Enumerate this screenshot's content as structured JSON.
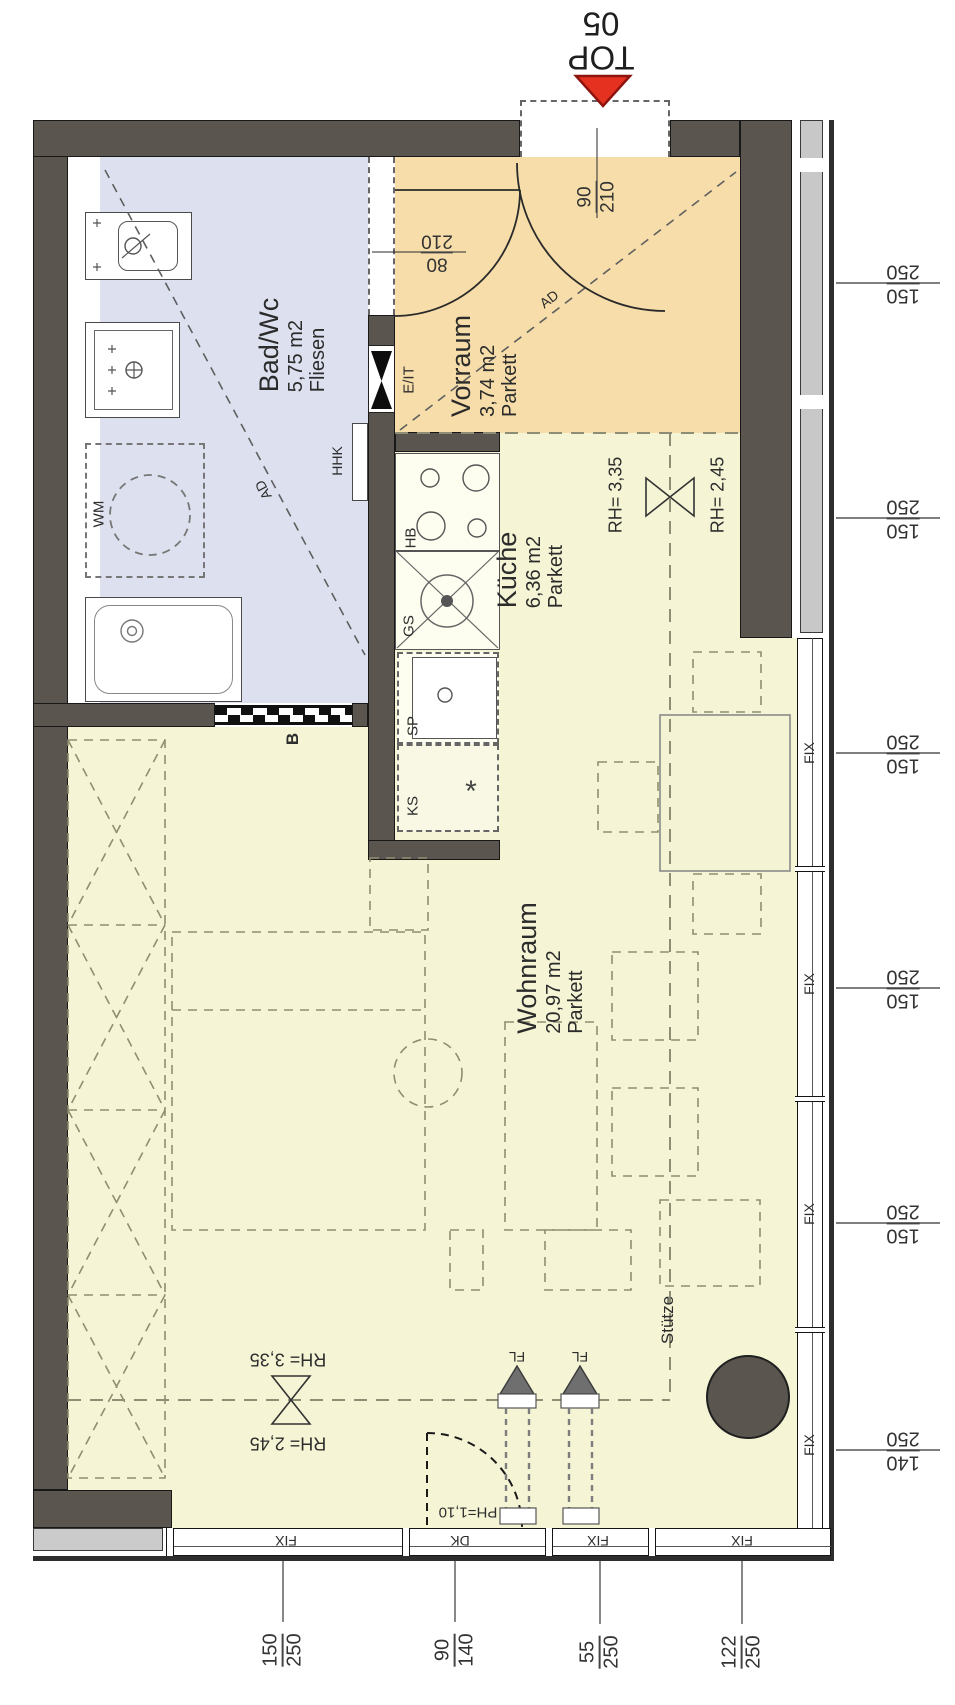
{
  "marker": {
    "line1": "TOP",
    "line2": "05"
  },
  "rooms": {
    "bad": {
      "name": "Bad/Wc",
      "area": "5,75  m2",
      "floor": "Fliesen"
    },
    "vorraum": {
      "name": "Vorraum",
      "area": "3,74  m2",
      "floor": "Parkett"
    },
    "kueche": {
      "name": "Küche",
      "area": "6,36  m2",
      "floor": "Parkett"
    },
    "wohnraum": {
      "name": "Wohnraum",
      "area": "20,97 m2",
      "floor": "Parkett"
    }
  },
  "doors": {
    "bad": {
      "num": "80",
      "den": "210"
    },
    "entry": {
      "num": "90",
      "den": "210"
    },
    "dk_parapet": "PH=1,10"
  },
  "ceiling": {
    "rh_high": "RH= 3,35",
    "rh_low": "RH= 2,45"
  },
  "labels": {
    "hhk": "HHK",
    "eit": "E/IT",
    "wm": "WM",
    "sliding_door": "B",
    "ad": "AD",
    "hb": "HB",
    "gs": "GS",
    "sp": "SP",
    "ks": "KS",
    "star": "*",
    "column": "Stütze",
    "fl": "FL",
    "dk": "DK",
    "fix": "FIX"
  },
  "dims": {
    "right": [
      {
        "num": "150",
        "den": "250"
      },
      {
        "num": "150",
        "den": "250"
      },
      {
        "num": "150",
        "den": "250"
      },
      {
        "num": "150",
        "den": "250"
      },
      {
        "num": "150",
        "den": "250"
      },
      {
        "num": "140",
        "den": "250"
      }
    ],
    "bottom": [
      {
        "num": "150",
        "den": "250"
      },
      {
        "num": "90",
        "den": "140"
      },
      {
        "num": "55",
        "den": "250"
      },
      {
        "num": "122",
        "den": "250"
      }
    ]
  },
  "colors": {
    "wall": "#5b554f",
    "bad_floor": "#dde1ef",
    "vorraum_floor": "#f6dda9",
    "main_floor": "#f5f5d6",
    "accent_red": "#e5311f"
  }
}
